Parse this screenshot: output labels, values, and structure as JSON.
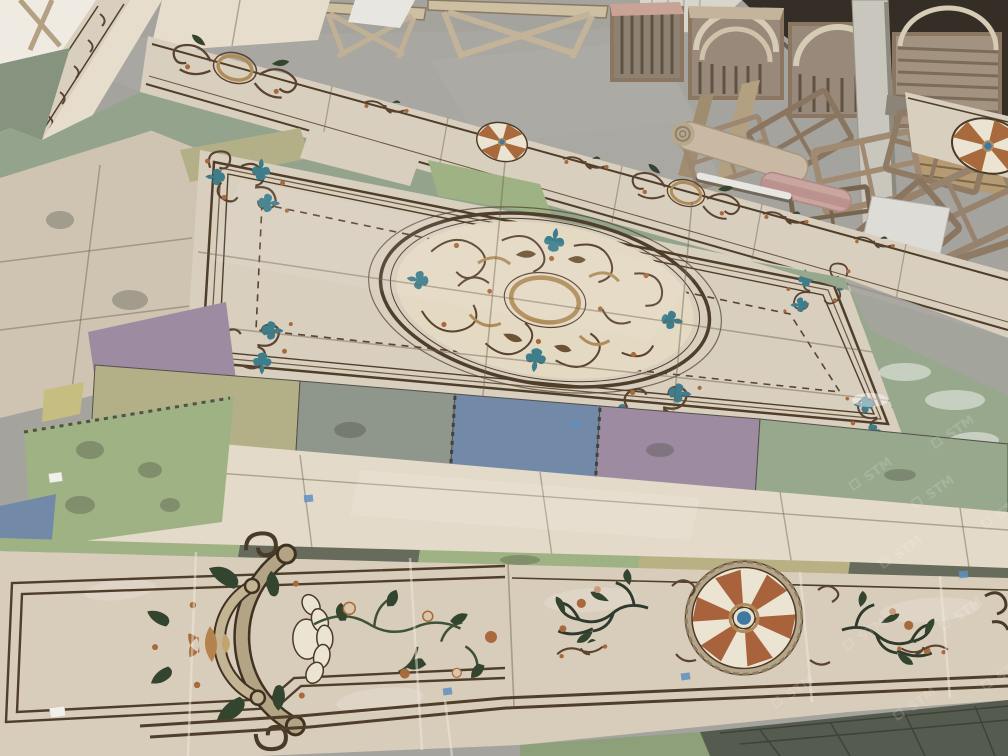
{
  "scene": {
    "setting": "stone factory workshop interior, high camera angle",
    "subject": "hand-laid waterjet marble inlay flooring panels being assembled on colored foam underlay mats",
    "watermark": {
      "text": "STM",
      "color": "#ffffff",
      "opacity": 0.16
    },
    "objects": {
      "background": [
        "concrete-floor",
        "white-wall",
        "dark-doorway",
        "timber-stack",
        "concrete-pillar",
        "work-tables",
        "pallet-crates-with-curved-marble-pieces",
        "stacked-wooden-frames",
        "material-rolls",
        "white-tubes",
        "white-board",
        "white-debris-sheets"
      ],
      "floor": [
        "upper-border-strip-with-cartouches-and-rosettes",
        "main-marble-field-panel",
        "triple-line-border-frame",
        "corner-scroll-ornaments",
        "central-oval-scroll-medallion",
        "foam-underlay-mats",
        "plain-marble-band",
        "bottom-border-panel-left-grand-cartouche",
        "rose-vine-inlay",
        "bottom-border-panel-fan-medallion",
        "dark-leaf-vine-inlays",
        "blue-tape-markers",
        "white-label-tags"
      ]
    }
  },
  "palette": {
    "concrete": "#a4a39d",
    "dark_opening": "#342e27",
    "marble_cream": "#d9cfbf",
    "marble_light": "#e4dac9",
    "marble_polished": "#d8ccba",
    "medallion_ivory": "#e4d9c3",
    "line_brown": "#4f3e2a",
    "ornament_brown": "#5a4330",
    "ornament_tan": "#b3a486",
    "ornament_rust": "#a8693c",
    "ornament_green": "#33452f",
    "ornament_teal": "#3e7d8c",
    "mat_green": "#9fb284",
    "mat_sage": "#93a38c",
    "mat_blue": "#7289a8",
    "mat_purple": "#9d8ca1",
    "mat_yellow": "#b3b088",
    "mat_gray": "#8f968c",
    "mat_dark": "#666b5c",
    "fan_rust": "#a8633c",
    "fan_center_blue": "#3f78a0",
    "tape_blue": "#5f8fc0"
  }
}
